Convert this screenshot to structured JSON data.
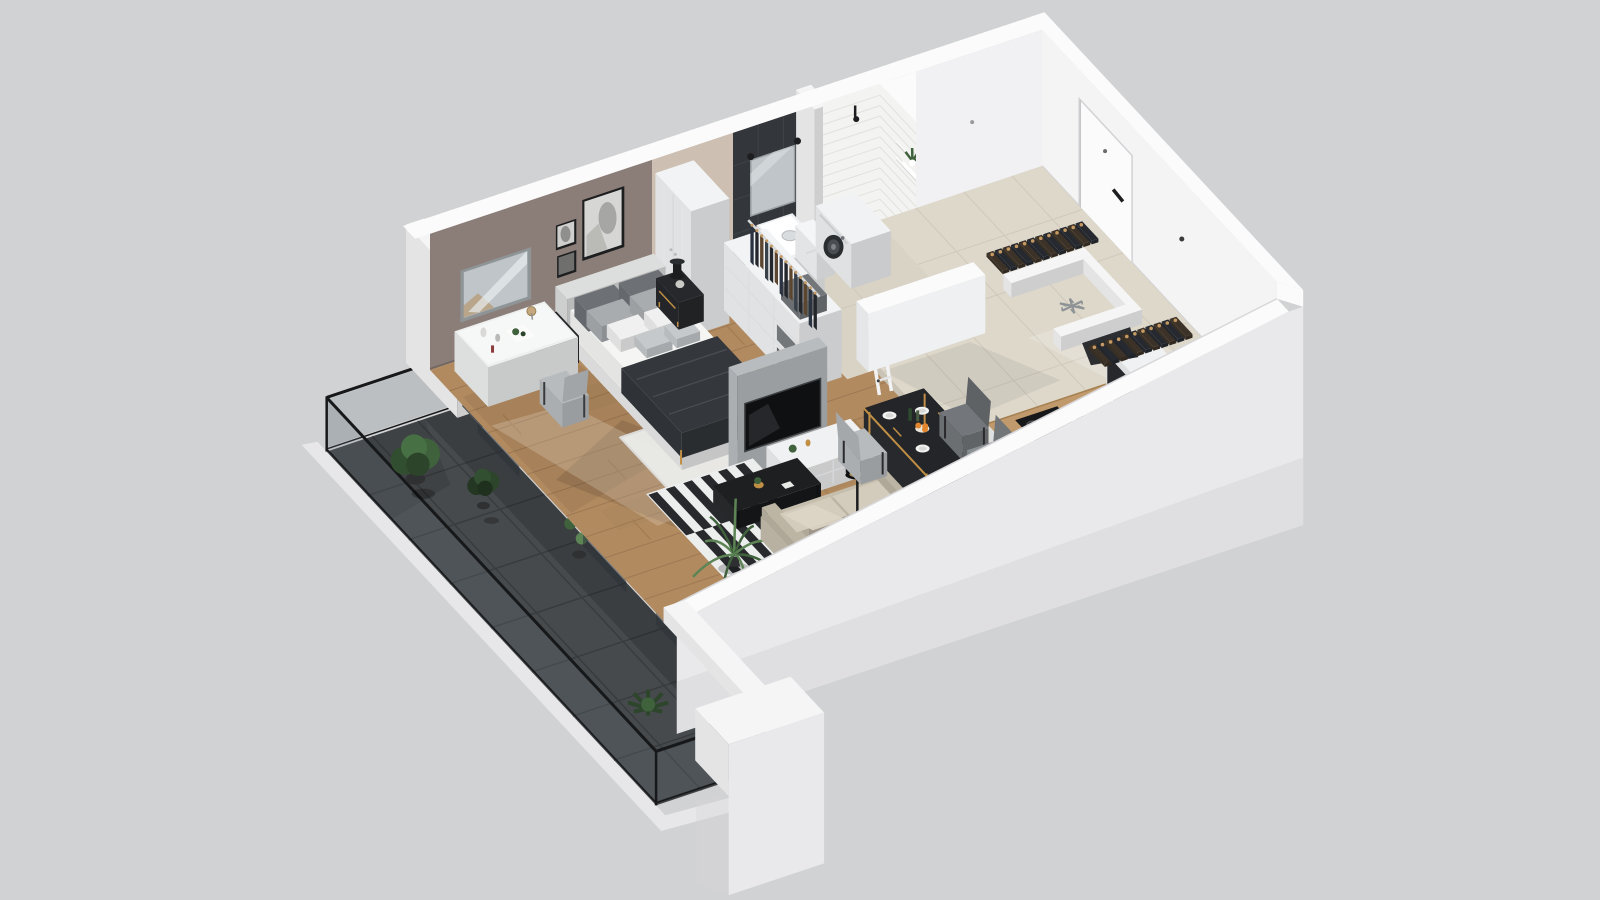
{
  "scene": {
    "type": "isometric-3d-floorplan-render",
    "background": "#d1d2d3",
    "rooms": [
      "bedroom",
      "living-area",
      "dining-area",
      "kitchen",
      "bathroom",
      "shower-room",
      "entrance-hall",
      "dressing-area",
      "balcony"
    ]
  },
  "colors": {
    "background": "#d1d2d3",
    "wallWhite": "#f5f5f6",
    "wallBright": "#fbfbfc",
    "wallShade": "#e7e7ea",
    "wallGray": "#d8d8db",
    "outerFace": "#e9e9eb",
    "slabShade": "#d6d6d9",
    "taupe": "#8b7d77",
    "beigeWall": "#cdbfb1",
    "darkTile": "#33373b",
    "darkTileLine": "#3f4347",
    "subway": "#f3f3f1",
    "subwayLine": "#e2e1dd",
    "wood": "#b18a60",
    "woodLine": "#9d7852",
    "woodDark": "#a57e53",
    "tile": "#ded8cb",
    "tileLine": "#cfc9bc",
    "bathFloor": "#d9d3c6",
    "balconyTile": "#474a4d",
    "balconyLine": "#393c3f",
    "railFrame": "#17181a",
    "glassTint": "rgba(110,122,130,0.22)",
    "glassDoor": "rgba(44,50,56,0.55)",
    "blind": "#edeff0",
    "blindShade": "#d5d8da",
    "rugWhite": "#ebecea",
    "stripeDark": "#27292c",
    "stripeLight": "#eceded",
    "mattress": "#f5f5f4",
    "bedBase": "#e9eae9",
    "headboard": "#dcdddd",
    "pillowDark": "#6d7175",
    "pillowGray": "#a8acaf",
    "pillowLight": "#c6c9cb",
    "pillowWhite": "#eff0ef",
    "throw": "#34383c",
    "furnBlack": "#26282b",
    "gold": "#c08f45",
    "sofa": "#c6bead",
    "sofaSeat": "#d3ccbc",
    "sofaBack": "#bcb4a3",
    "tvPanel": "#b8bcbf",
    "tvScreen": "#0f1012",
    "console": "#f0f1f2",
    "chairLight": "#b7bbbe",
    "chairDark": "#73777b",
    "wardrobe": "#f2f3f4",
    "boxGray": "#74777a",
    "boxDark": "#5b5e61",
    "clothes1": "#2b3240",
    "clothes2": "#23262b",
    "clothes3": "#5d4630",
    "clothes4": "#384049",
    "hangerTan": "#c59a62",
    "plantGreen": "#3f613c",
    "plantDark": "#2c452b",
    "plantLight": "#5d8455",
    "potDark": "#2e3032",
    "orange": "#e1862f",
    "lemonPlate": "#d2b83a",
    "bottleGreen": "#2e4a2e",
    "washer": "#f1f2f3",
    "washerDoor": "#2b2e31",
    "steel": "#9fa5a9",
    "mirror": "#bfc5c8",
    "mirrorFrame": "#8f9497",
    "frameBlack": "#1d1e20",
    "artInner": "#d6d6d4",
    "artGray": "#a6a6a4",
    "shadow": "rgba(0,0,0,0.10)",
    "shadowSoft": "rgba(0,0,0,0.06)",
    "sun": "rgba(255,250,238,0.20)"
  },
  "furniture": {
    "bedroom": [
      "double-bed",
      "headboard",
      "pillows",
      "dark-throw-blanket",
      "nightstand-left",
      "nightstand-right",
      "table-lamp",
      "vanity-desk",
      "desk-mirror",
      "desk-chair",
      "white-rug",
      "wall-art-frames",
      "tall-wardrobe"
    ],
    "dressing-area": [
      "open-shelf-unit",
      "hanging-clothes-rail",
      "storage-boxes"
    ],
    "living-area": [
      "tv-partition",
      "tv-screen",
      "tv-console",
      "striped-rug",
      "coffee-table",
      "sofa",
      "floor-lamp",
      "palm-plant"
    ],
    "dining-area": [
      "dining-table",
      "dining-chairs",
      "tableware",
      "fruit-bowl"
    ],
    "kitchen": [
      "kitchen-counter",
      "induction-hob",
      "kettle",
      "sink",
      "faucet",
      "counter-return",
      "fridge-space-snowflake"
    ],
    "bathroom": [
      "vanity-sink",
      "wall-mirror",
      "washing-machine",
      "storage-bins",
      "towel-ladder",
      "wall-shelves",
      "shelf-plant",
      "shower-head"
    ],
    "entrance-hall": [
      "entrance-door",
      "door-handle",
      "leaning-mirror",
      "shoe-rows"
    ],
    "balcony": [
      "glass-railing",
      "potted-bushes",
      "monstera-plant",
      "leafy-plant",
      "slat-blinds",
      "sliding-glass-doors",
      "dark-floor-tiles"
    ]
  }
}
